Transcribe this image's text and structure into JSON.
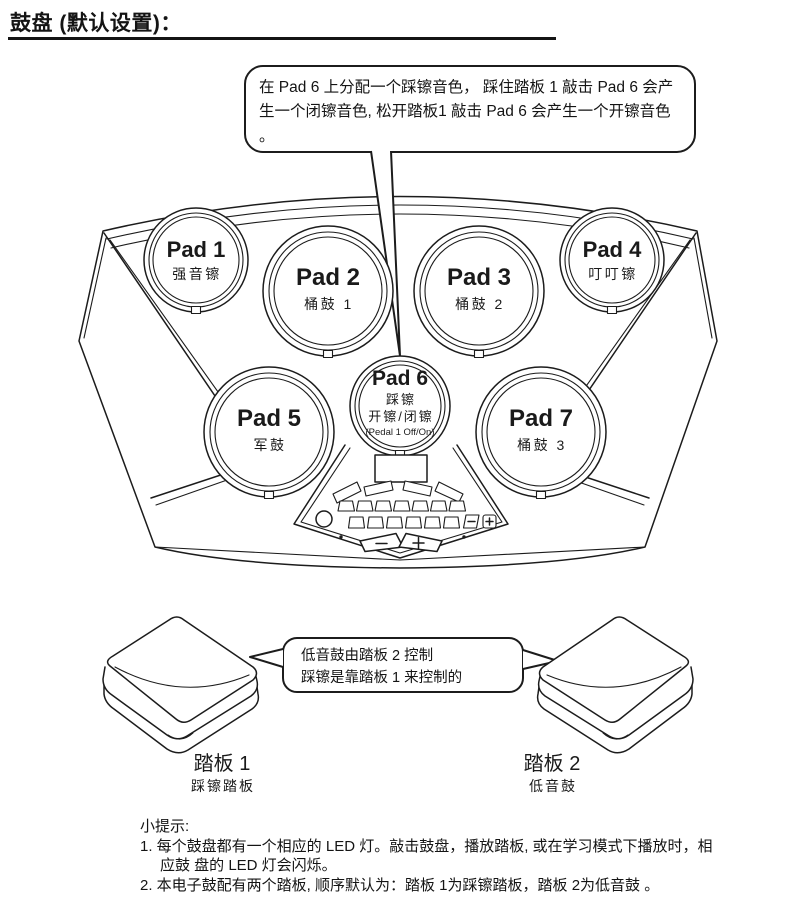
{
  "page": {
    "title": "鼓盘 (默认设置)："
  },
  "callouts": {
    "pad6": "在 Pad 6 上分配一个踩镲音色， 踩住踏板 1 敲击 Pad 6 会产生一个闭镲音色, 松开踏板1 敲击 Pad 6 会产生一个开镲音色 。",
    "pedal_line1": "低音鼓由踏板 2 控制",
    "pedal_line2": "踩镲是靠踏板 1 来控制的"
  },
  "pads": [
    {
      "name": "Pad 1",
      "label": "强音镲"
    },
    {
      "name": "Pad 2",
      "label": "桶鼓 1"
    },
    {
      "name": "Pad 3",
      "label": "桶鼓 2"
    },
    {
      "name": "Pad 4",
      "label": "叮叮镲"
    },
    {
      "name": "Pad 5",
      "label": "军鼓"
    },
    {
      "name": "Pad 6",
      "label": "踩镲",
      "label2": "开镲/闭镲",
      "label3": "(Pedal 1 Off/On)"
    },
    {
      "name": "Pad 7",
      "label": "桶鼓 3"
    }
  ],
  "pedals": [
    {
      "name": "踏板 1",
      "label": "踩镲踏板"
    },
    {
      "name": "踏板 2",
      "label": "低音鼓"
    }
  ],
  "notes": {
    "heading": "小提示:",
    "items": [
      "1. 每个鼓盘都有一个相应的 LED 灯。敲击鼓盘，播放踏板, 或在学习模式下播放时，相应鼓 盘的 LED 灯会闪烁。",
      "2. 本电子鼓配有两个踏板, 顺序默认为：踏板 1为踩镲踏板，踏板 2为低音鼓 。"
    ]
  }
}
